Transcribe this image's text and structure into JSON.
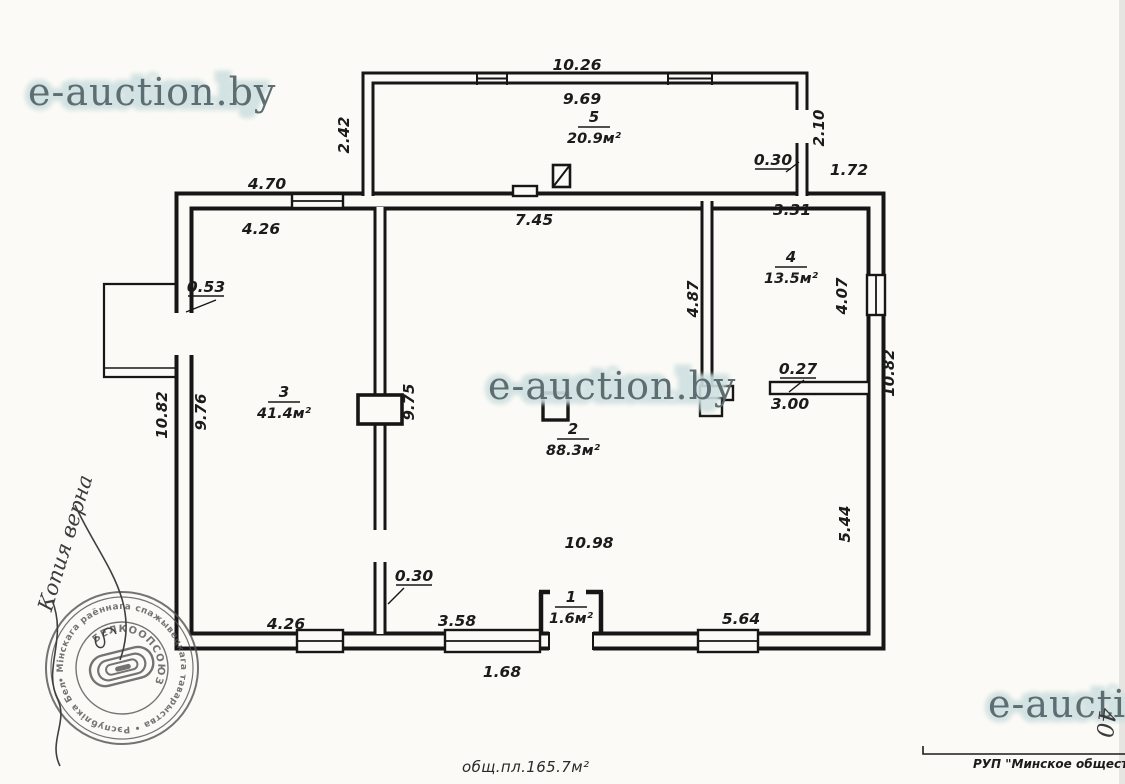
{
  "watermark": {
    "text": "e-auction.by",
    "text_partial": "e-auction",
    "ink": "#5d6e73",
    "halo": "#cfe0e0"
  },
  "rooms": [
    {
      "num": "5",
      "area": "20.9м²"
    },
    {
      "num": "4",
      "area": "13.5м²"
    },
    {
      "num": "3",
      "area": "41.4м²"
    },
    {
      "num": "2",
      "area": "88.3м²"
    },
    {
      "num": "1",
      "area": "1.6м²"
    }
  ],
  "dims": {
    "veranda_width_outer": "10.26",
    "veranda_width_inner": "9.69",
    "veranda_left": "2.42",
    "veranda_right": "2.10",
    "chimney": "0.30",
    "top_right": "1.72",
    "top_left_outer": "4.70",
    "top_left_inner": "4.26",
    "room2_top": "7.45",
    "room4_top": "3.31",
    "left_stub": "0.53",
    "window_right": "4.07",
    "partition_room4": "4.87",
    "right_outer": "10.82",
    "shelf_t": "0.27",
    "shelf_len": "3.00",
    "left_outer": "10.82",
    "left_inner": "9.76",
    "partition_a": "9.75",
    "right_inner": "5.44",
    "room2_bottom": "10.98",
    "bottom_stub": "0.30",
    "bottom_left": "4.26",
    "bottom_mid": "3.58",
    "bottom_right": "5.64",
    "bottom_window": "1.68"
  },
  "footer": {
    "total_area": "общ.пл.165.7м²",
    "org": "РУП \"Минское общество",
    "sheet": "40"
  },
  "handwriting": {
    "note": "Копия верна"
  },
  "stamp": {
    "ring": "• Мінскага раённага спажывецкага таварыства • Рэспубліка Беларусь",
    "center": "БЕЛКООПСОЮЗ"
  },
  "colors": {
    "ink": "#1b1b1b",
    "paper": "#fbfaf6",
    "stamp": "#525252"
  }
}
